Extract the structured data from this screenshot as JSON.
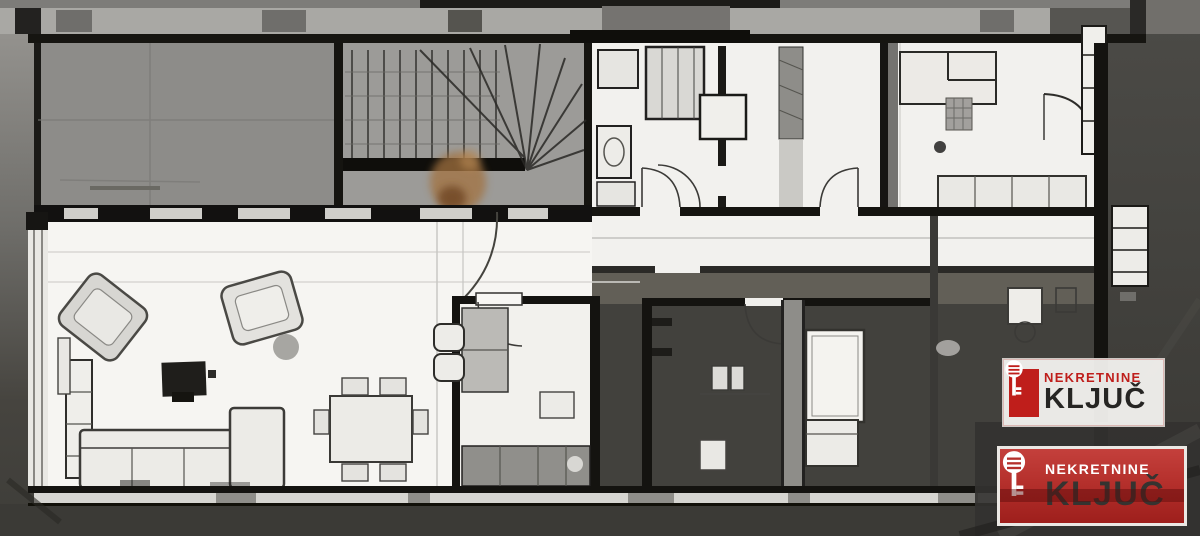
{
  "watermark_badges": [
    {
      "variant": "light",
      "agency_line": "NEKRETNINE",
      "brand_line": "KLJUČ"
    },
    {
      "variant": "red",
      "agency_line": "NEKRETNINE",
      "brand_line": "KLJUČ"
    }
  ],
  "icons": [
    {
      "name": "key-icon",
      "meaning": "real-estate agency key logo"
    }
  ],
  "colors": {
    "brand_red": "#bf1e1b",
    "badge_red_bg": "#b5302c",
    "badge_light_bg": "#f6f5f3",
    "brand_dark_text": "#2a2927",
    "brand_light_text": "#ffffff",
    "plan_paper": "#f2f1ee",
    "terrace_gray": "#8d8c8a",
    "stairwell_gray": "#9c9b98",
    "wall_black": "#161511",
    "background_dark": "#41403c"
  }
}
